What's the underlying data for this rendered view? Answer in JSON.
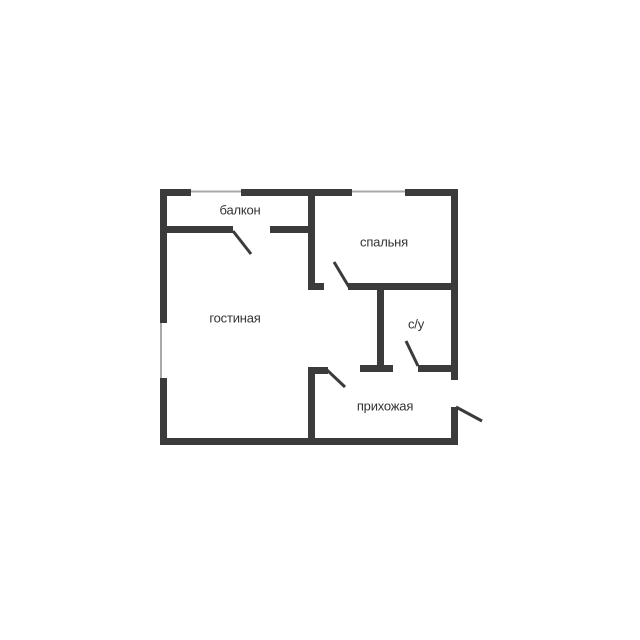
{
  "colors": {
    "wall": "#3b3b3b",
    "window": "#a9a9a9",
    "label": "#333333",
    "background": "#ffffff"
  },
  "rooms": [
    {
      "id": "balcony",
      "label": "балкон"
    },
    {
      "id": "bedroom",
      "label": "спальня"
    },
    {
      "id": "living-room",
      "label": "гостиная"
    },
    {
      "id": "bathroom",
      "label": "с/у"
    },
    {
      "id": "hallway",
      "label": "прихожая"
    }
  ],
  "openings": {
    "windows": [
      "balcony-window",
      "bedroom-window",
      "living-room-window"
    ],
    "doors": [
      "balcony-door",
      "bedroom-door",
      "bathroom-door",
      "hallway-door",
      "entrance-door"
    ]
  }
}
